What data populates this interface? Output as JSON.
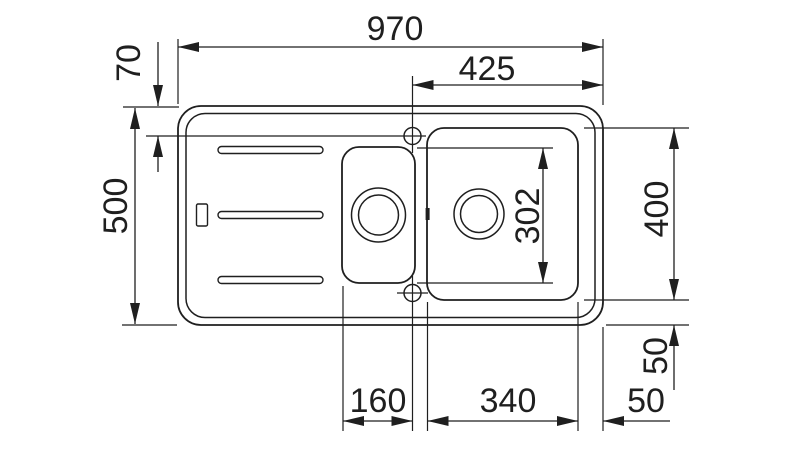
{
  "colors": {
    "ink": "#1f1f1f",
    "background": "#ffffff"
  },
  "dimensions": {
    "overall_width": "970",
    "top_right_width": "425",
    "top_edge_offset": "70",
    "overall_depth": "500",
    "main_bowl_inner_depth": "302",
    "main_bowl_depth": "400",
    "bowl_bottom_edge_offset": "50",
    "bowl_right_edge_offset": "50",
    "small_bowl_width": "160",
    "main_bowl_width": "340"
  }
}
